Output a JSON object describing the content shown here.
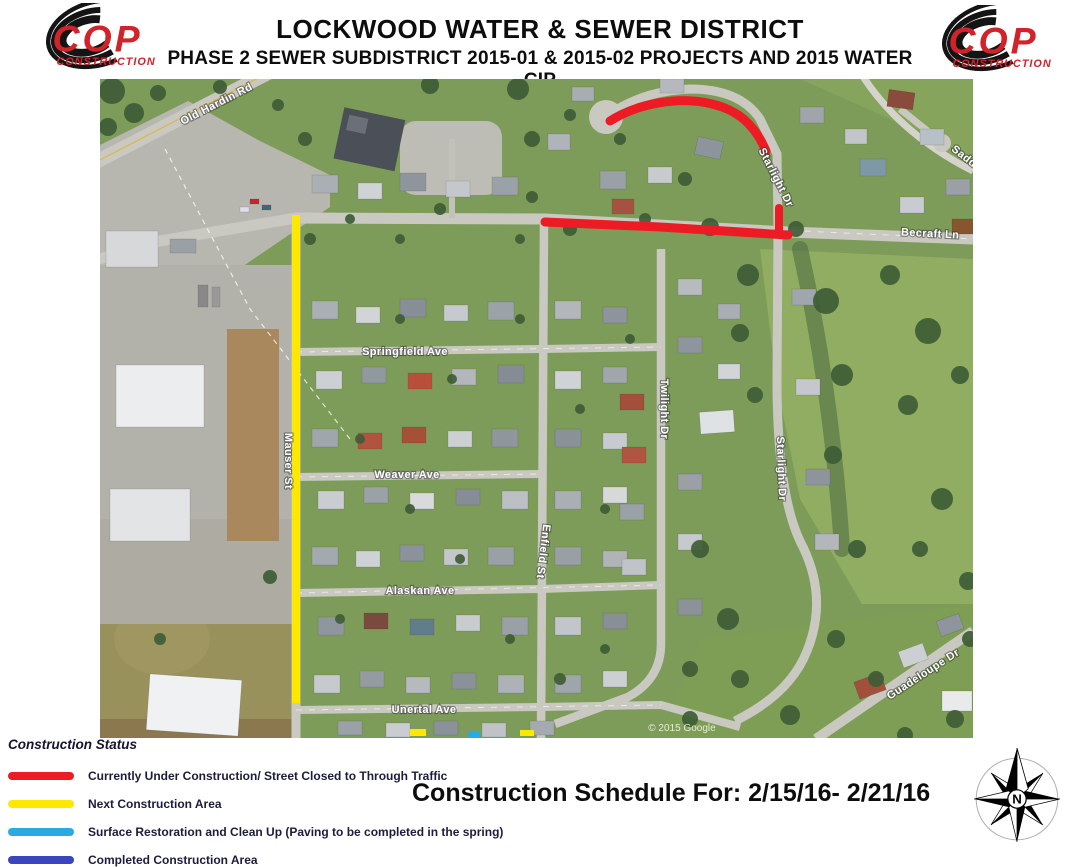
{
  "header": {
    "title": "LOCKWOOD WATER & SEWER DISTRICT",
    "subtitle": "PHASE 2 SEWER SUBDISTRICT 2015-01 & 2015-02 PROJECTS AND 2015 WATER CIP",
    "logo": {
      "name": "COP",
      "subname": "CONSTRUCTION"
    }
  },
  "map": {
    "labels": {
      "old_hardin": "Old Hardin Rd",
      "becraft": "Becraft Ln",
      "saddle_partial": "Sadd",
      "springfield": "Springfield Ave",
      "weaver": "Weaver Ave",
      "alaskan": "Alaskan Ave",
      "unertal": "Unertal Ave",
      "mauser": "Mauser St",
      "enfield": "Enfield St",
      "twilight": "Twilight Dr",
      "starlight": "Starlight Dr",
      "guadeloupe": "Guadeloupe Dr"
    },
    "watermark": "© 2015 Google",
    "overlay_colors": {
      "current": "#ED1C24",
      "next": "#FFE800"
    }
  },
  "legend": {
    "heading": "Construction Status",
    "items": [
      {
        "label": "Currently Under Construction/ Street Closed to Through  Traffic",
        "color": "#ED1C24"
      },
      {
        "label": "Next Construction Area",
        "color": "#FFE800"
      },
      {
        "label": "Surface Restoration and Clean Up (Paving to be completed in the spring)",
        "color": "#29ABE2"
      },
      {
        "label": "Completed Construction Area",
        "color": "#3B45BE"
      }
    ]
  },
  "schedule": {
    "text": "Construction Schedule For: 2/15/16- 2/21/16"
  },
  "compass": {
    "north_label": "N"
  }
}
